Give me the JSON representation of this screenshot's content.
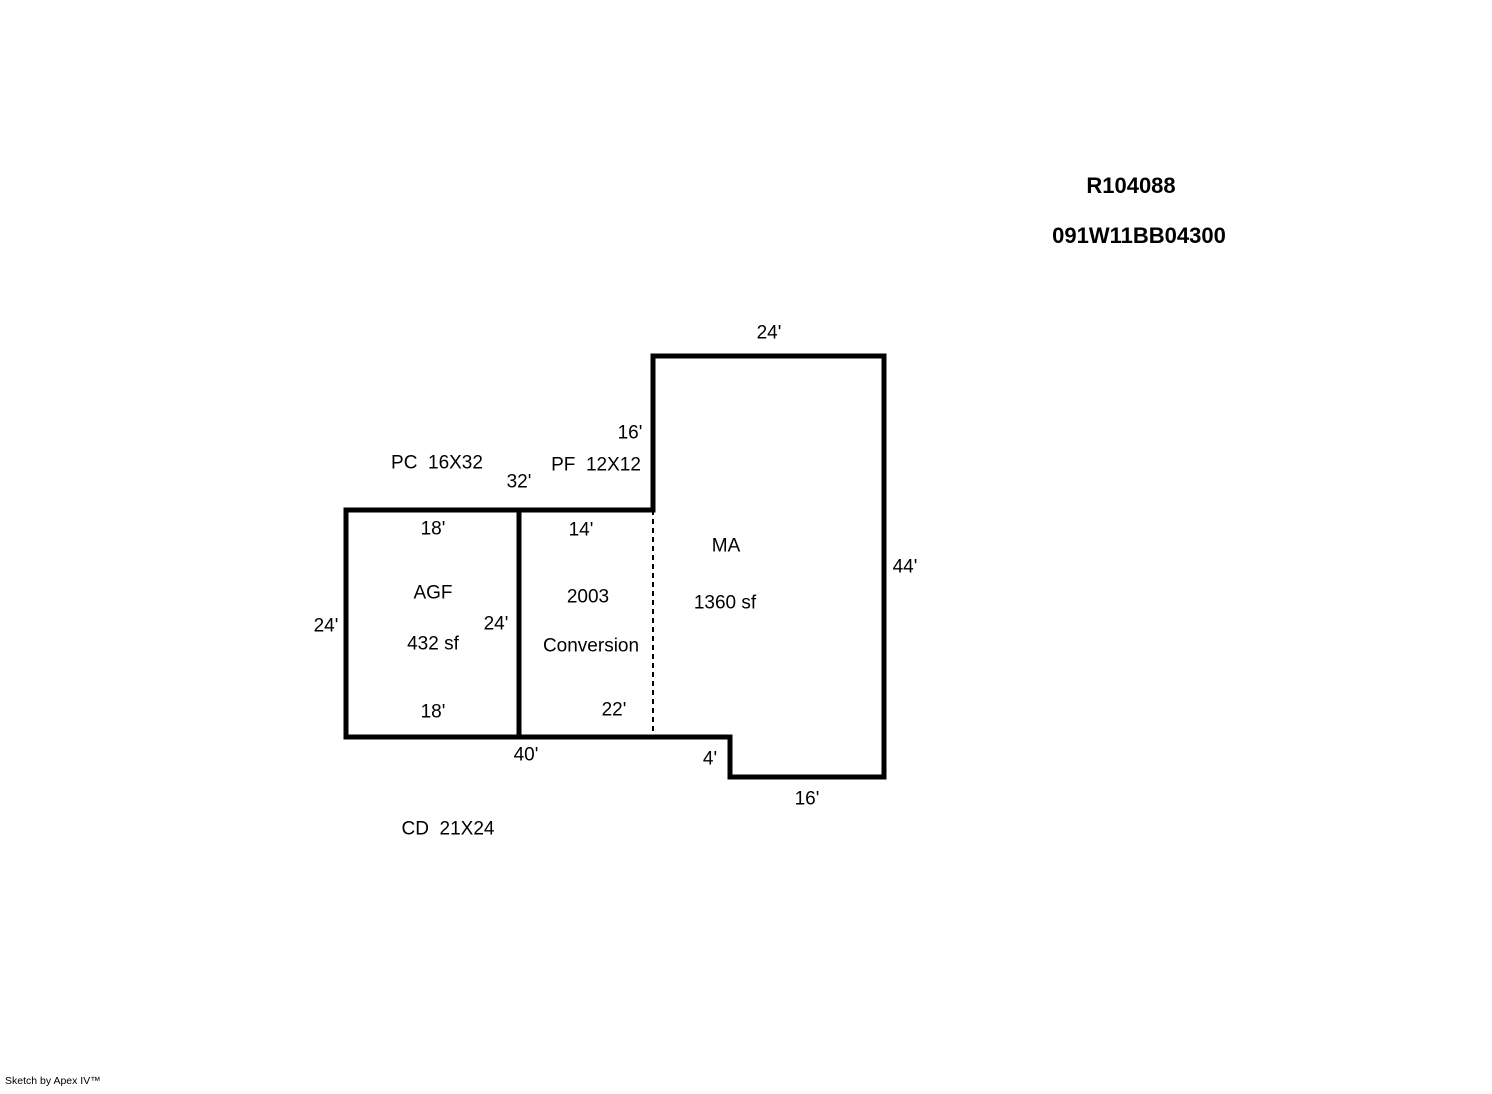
{
  "page": {
    "background_color": "#ffffff",
    "line_color": "#000000"
  },
  "header": {
    "account_number": "R104088",
    "map_taxlot": "091W11BB04300"
  },
  "sketch": {
    "labels": {
      "ma_top_width": "24'",
      "ma_upper_left_height": "16'",
      "pc_note": "PC  16X32",
      "pf_note": "PF  12X12",
      "top_total_width": "32'",
      "agf_top_width": "18'",
      "conv_top_width": "14'",
      "ma_name": "MA",
      "ma_right_height": "44'",
      "agf_name": "AGF",
      "conv_year": "2003",
      "ma_area": "1360 sf",
      "agf_right_height": "24'",
      "agf_left_height": "24'",
      "agf_area": "432 sf",
      "conv_name": "Conversion",
      "conv_bottom_width": "22'",
      "agf_bottom_width": "18'",
      "bottom_total_width": "40'",
      "notch_height": "4'",
      "bottom_right_width": "16'",
      "cd_note": "CD  21X24"
    }
  },
  "footer": {
    "credit": "Sketch by Apex IV™"
  }
}
